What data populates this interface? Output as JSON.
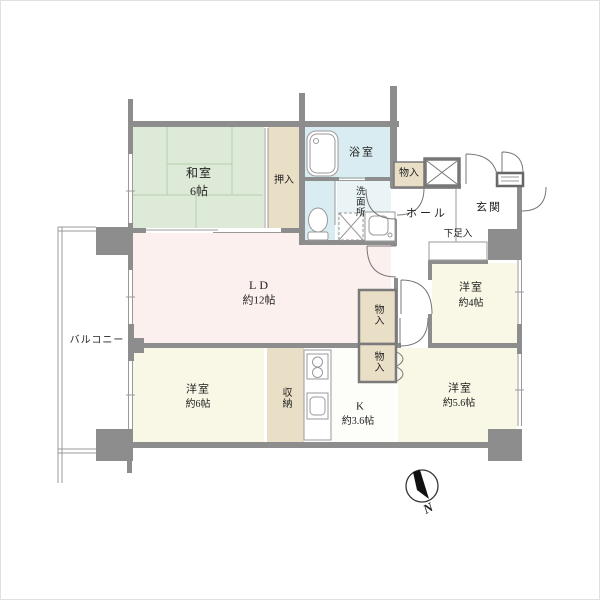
{
  "title": "apartment-floor-plan",
  "labels": {
    "washitsu_name": "和室",
    "washitsu_size": "6帖",
    "oshiire": "押入",
    "bath": "浴室",
    "senmenjo": "洗面所",
    "mono_entry": "物入",
    "hall": "ホール",
    "genkan": "玄関",
    "getabako": "下足入",
    "yoshitsu4_name": "洋室",
    "yoshitsu4_size": "約4帖",
    "ld_name": "LD",
    "ld_size": "約12帖",
    "mono1": "物入",
    "mono2": "物入",
    "balcony": "バルコニー",
    "yoshitsu6_name": "洋室",
    "yoshitsu6_size": "約6帖",
    "shuno": "収納",
    "kitchen_name": "K",
    "kitchen_size": "約3.6帖",
    "yoshitsu56_name": "洋室",
    "yoshitsu56_size": "約5.6帖",
    "compass_north": "N"
  },
  "icons": [
    "bathtub-icon",
    "toilet-icon",
    "washer-pan-icon",
    "vanity-sink-icon",
    "stove-icon",
    "kitchen-sink-icon",
    "meter-box-icon",
    "door-sill-icon",
    "compass-icon"
  ],
  "colors": {
    "wall": "#8d8d8d",
    "tatami": "#dcead7",
    "tatami_line": "#b7cdb2",
    "closet": "#e9dfc7",
    "bath": "#d9ecf1",
    "washroom": "#eaf4f6",
    "living": "#fbf0ed",
    "western_room": "#f9f7e5",
    "kitchen_floor": "#fdfdf9",
    "thin_line": "#9a9a9a",
    "door_arc": "#777777",
    "compass": "#111111"
  }
}
